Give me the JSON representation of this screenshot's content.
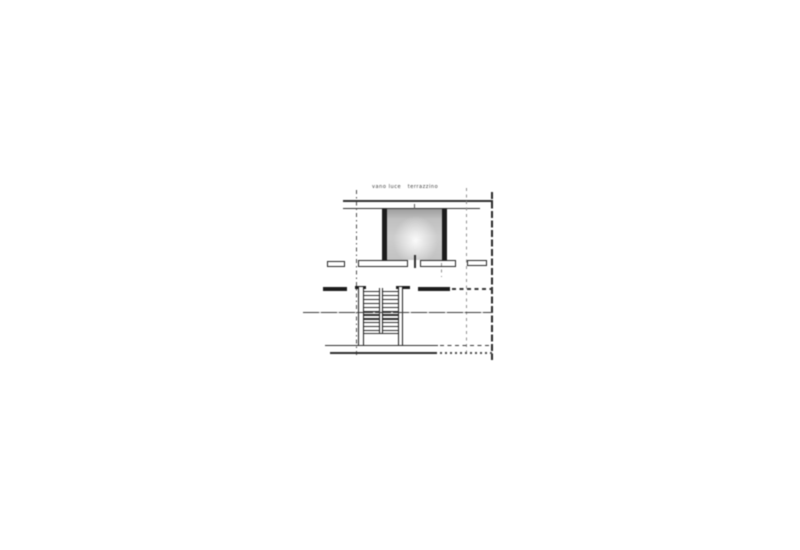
{
  "document": {
    "kind": "scanned architectural floor plan (stair bulkhead and roof terrace level)",
    "paper_color": "#ffffff",
    "ink_color": "#2e2e2e",
    "room_fill_color": "#c6c6c6",
    "labels": {
      "room_left": "vano luce",
      "room_right": "terrazzino"
    },
    "staircase": {
      "flights": 2,
      "treads_per_flight": 11,
      "layout": "double parallel flight with central divider wall"
    }
  }
}
